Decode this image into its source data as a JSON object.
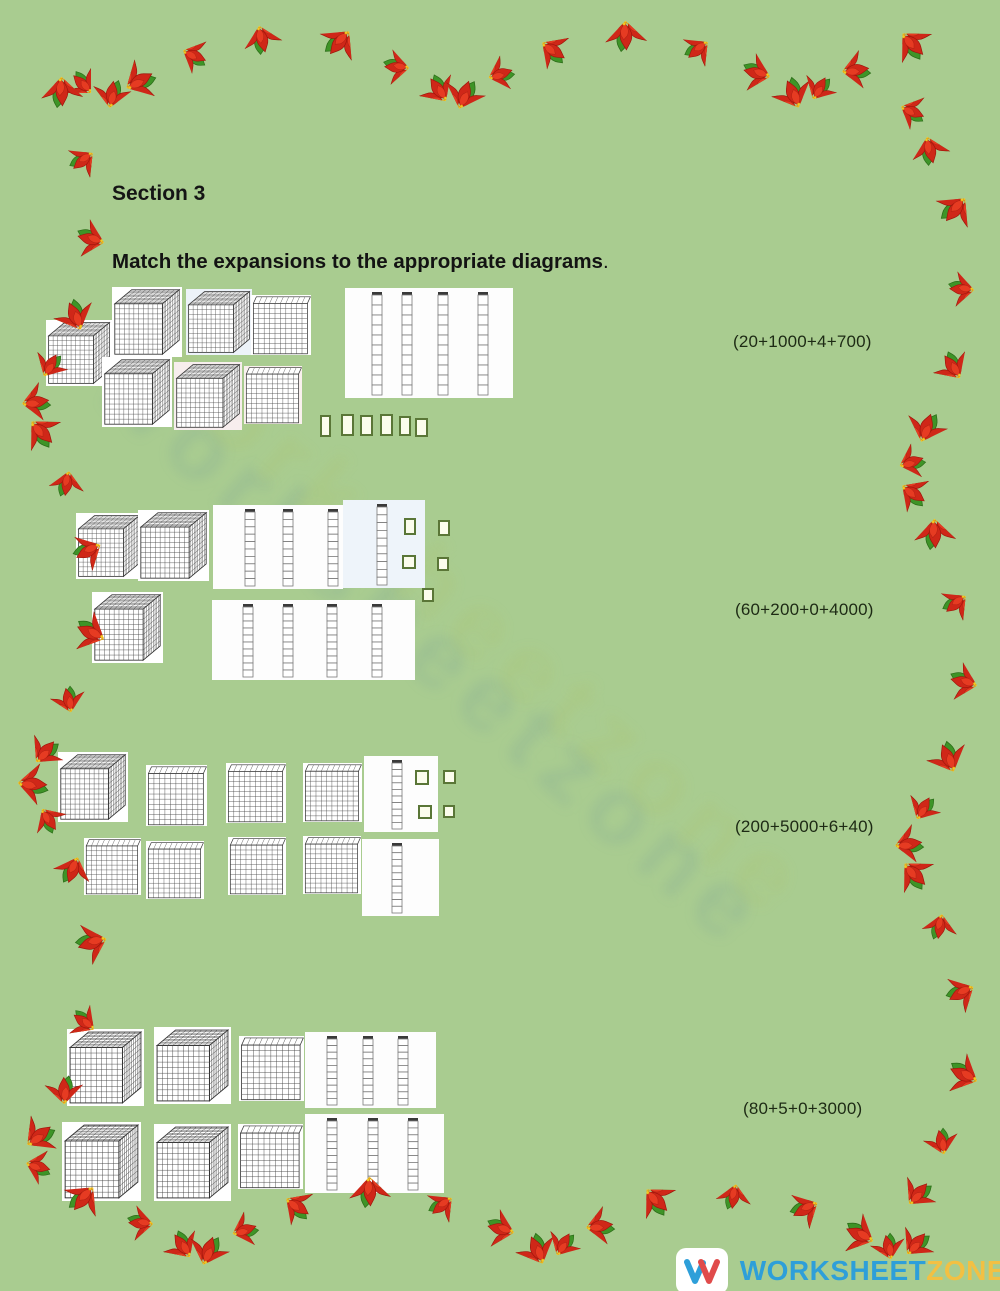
{
  "page": {
    "section_title": "Section 3",
    "instruction": "Match the expansions to the appropriate diagrams",
    "instruction_period": "."
  },
  "groups": [
    {
      "expression": "(20+1000+4+700)",
      "blocks": {
        "thousands": 5,
        "hundreds": 2,
        "tens": 4,
        "ones": 6
      },
      "depicted_value": 5246
    },
    {
      "expression": "(60+200+0+4000)",
      "blocks": {
        "thousands": 3,
        "hundreds": 0,
        "tens": 8,
        "ones": 5
      },
      "depicted_value": 3085
    },
    {
      "expression": "(200+5000+6+40)",
      "blocks": {
        "thousands": 1,
        "hundreds": 7,
        "tens": 2,
        "ones": 4
      },
      "depicted_value": 1724
    },
    {
      "expression": "(80+5+0+3000)",
      "blocks": {
        "thousands": 4,
        "hundreds": 2,
        "tens": 6,
        "ones": 0
      },
      "depicted_value": 4260
    }
  ],
  "watermark": "worksheetzone",
  "footer": {
    "brand_word1": "WORKSHEET",
    "brand_word2": "ZONE",
    "logo_letter": "W"
  },
  "colors": {
    "background": "#a9cc90",
    "unit_border": "#5a7637",
    "brand_blue": "#2e9fd9",
    "brand_yellow": "#f2c043",
    "petal_red": "#cf2718",
    "leaf_green": "#3e9427"
  }
}
